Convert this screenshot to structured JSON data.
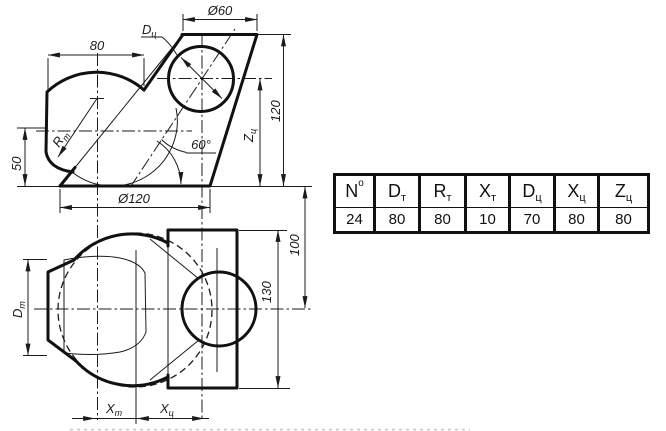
{
  "drawing": {
    "top_view": {
      "dia_top": "Ø60",
      "width_top": "80",
      "base_dia": "Ø120",
      "height_right": "120",
      "height_left": "50",
      "angle": "60°",
      "label_dc": {
        "main": "D",
        "sub": "ц"
      },
      "label_zc": {
        "main": "Z",
        "sub": "ц"
      },
      "label_rt": {
        "main": "R",
        "sub": "т"
      }
    },
    "front_view": {
      "depth": "100",
      "height": "130",
      "label_dt": {
        "main": "D",
        "sub": "т"
      },
      "label_xt": {
        "main": "X",
        "sub": "т"
      },
      "label_xc": {
        "main": "X",
        "sub": "ц"
      }
    }
  },
  "table": {
    "headers": [
      {
        "main": "N",
        "sup": "o"
      },
      {
        "main": "D",
        "sub": "т"
      },
      {
        "main": "R",
        "sub": "т"
      },
      {
        "main": "X",
        "sub": "т"
      },
      {
        "main": "D",
        "sub": "ц"
      },
      {
        "main": "X",
        "sub": "ц"
      },
      {
        "main": "Z",
        "sub": "ц"
      }
    ],
    "values": [
      "24",
      "80",
      "80",
      "10",
      "70",
      "80",
      "80"
    ]
  },
  "colors": {
    "ink": "#1b1b1b",
    "paper": "#ffffff"
  }
}
